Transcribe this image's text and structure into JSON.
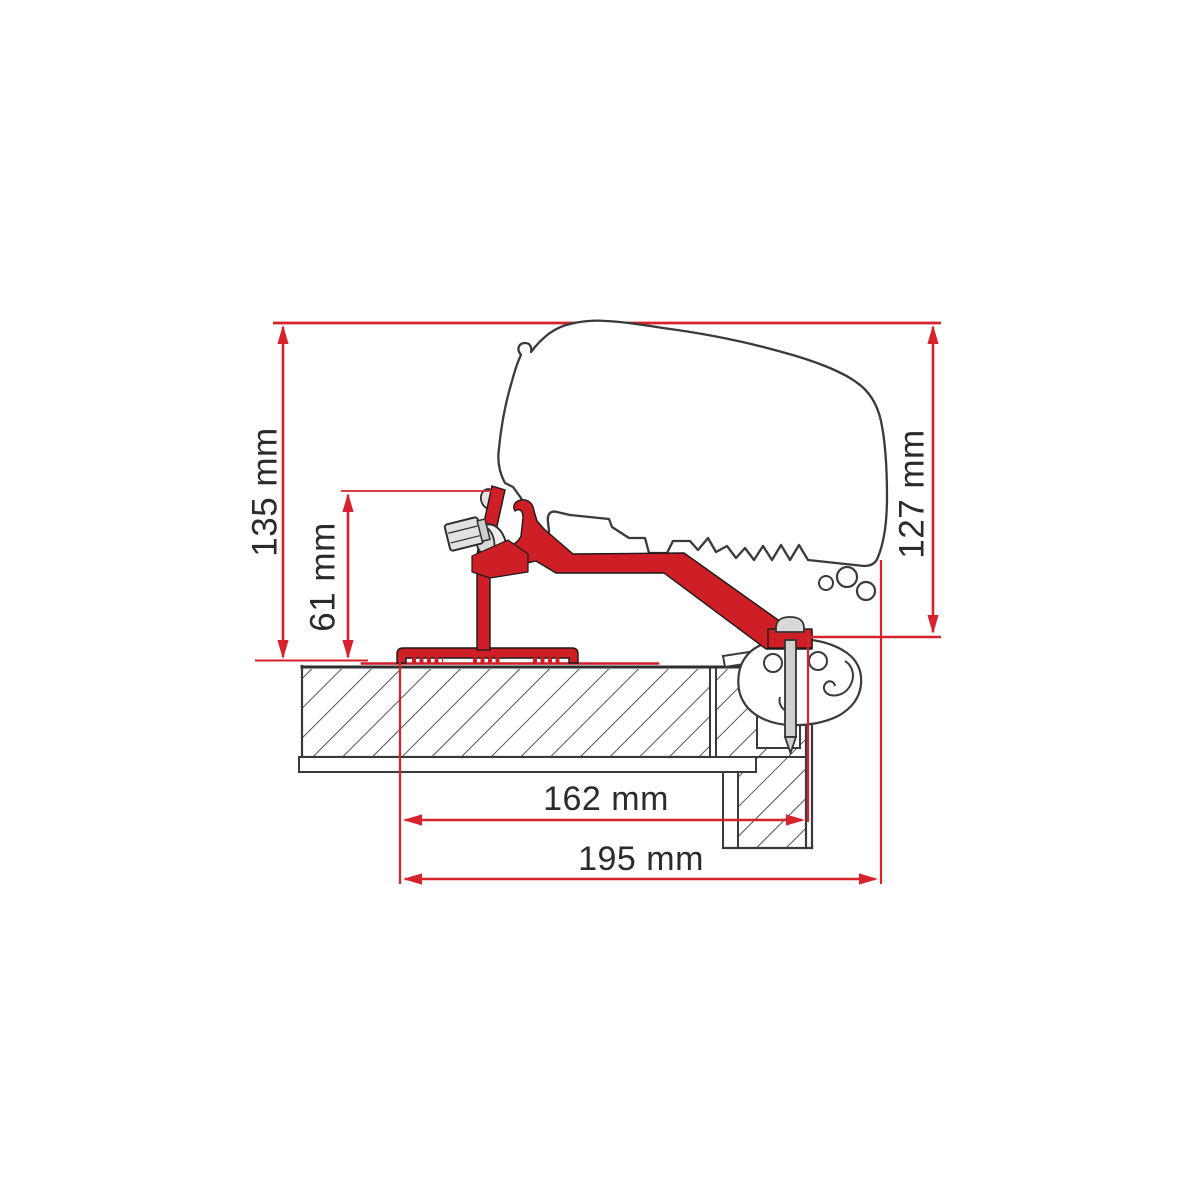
{
  "dims": {
    "h135": "135 mm",
    "h61": "61 mm",
    "h127": "127 mm",
    "w162": "162 mm",
    "w195": "195 mm"
  },
  "colors": {
    "dimension_red": "#d6232b",
    "bracket_red": "#ce1f26",
    "outline_gray": "#3a3a3a",
    "hatch_gray": "#4a4a4a",
    "metal_gray": "#e2e2e2",
    "text_color": "#2b2b2b",
    "background": "#ffffff"
  }
}
